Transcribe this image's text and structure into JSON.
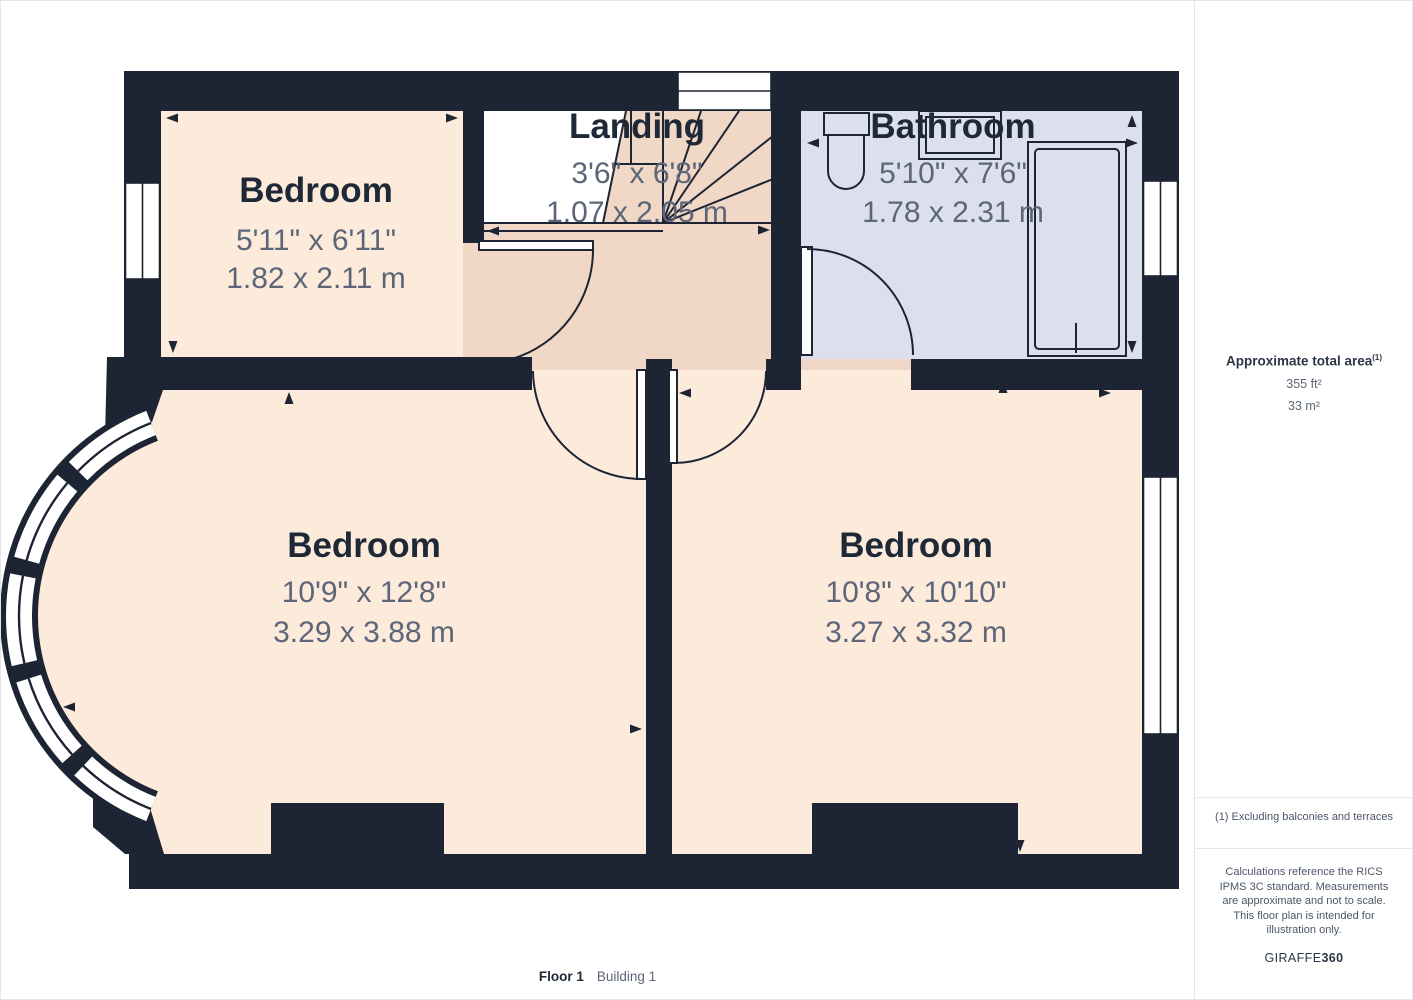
{
  "floorplan": {
    "rooms": [
      {
        "name": "Bedroom",
        "imperial": "5'11\" x 6'11\"",
        "metric": "1.82 x 2.11 m"
      },
      {
        "name": "Landing",
        "imperial": "3'6\" x 6'8\"",
        "metric": "1.07 x 2.05 m"
      },
      {
        "name": "Bathroom",
        "imperial": "5'10\" x 7'6\"",
        "metric": "1.78 x 2.31 m"
      },
      {
        "name": "Bedroom",
        "imperial": "10'9\" x 12'8\"",
        "metric": "3.29 x 3.88 m"
      },
      {
        "name": "Bedroom",
        "imperial": "10'8\" x 10'10\"",
        "metric": "3.27 x 3.32 m"
      }
    ],
    "floor_label": "Floor 1",
    "building_label": "Building 1"
  },
  "sidebar": {
    "total_area_label": "Approximate total area",
    "total_area_superscript": "(1)",
    "area_ft": "355 ft²",
    "area_m": "33 m²",
    "footnote": "(1) Excluding balconies and terraces",
    "disclaimer": "Calculations reference the RICS IPMS 3C standard. Measurements are approximate and not to scale. This floor plan is intended for illustration only.",
    "brand_regular": "GIRAFFE",
    "brand_bold": "360"
  },
  "colors": {
    "wall": "#1d2433",
    "bedroom_floor": "#fceadb",
    "landing_floor": "#f1d7c5",
    "bathroom_floor": "#dbe0ec",
    "room_name_text": "#1e2837",
    "dimension_text": "#5c6678"
  }
}
